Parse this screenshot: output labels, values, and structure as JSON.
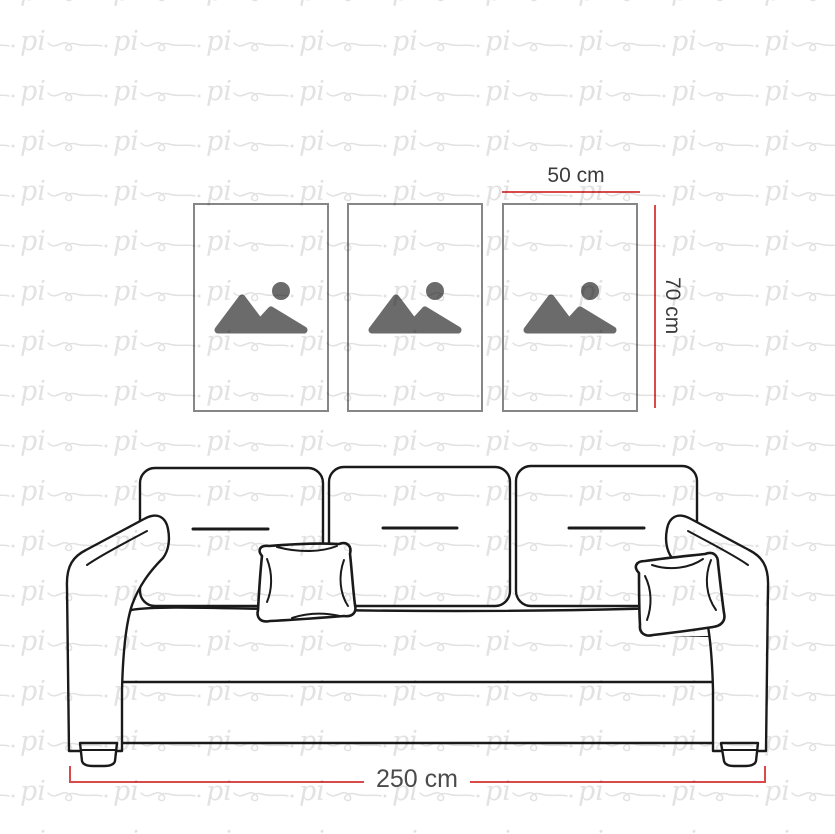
{
  "watermark": {
    "text": "pi",
    "color": "#e2e2e2"
  },
  "dimensions": {
    "frame_width": "50 cm",
    "frame_height": "70 cm",
    "sofa_width": "250 cm"
  },
  "frames": {
    "count": 3
  },
  "colors": {
    "measure_line": "#d94b4b",
    "artwork_line": "#1a1a1a",
    "frame_border": "#868686",
    "placeholder_icon": "#6b6b6b",
    "label_text": "#3c3c3c",
    "label_text_muted": "#4b4b4b",
    "background": "#ffffff"
  }
}
